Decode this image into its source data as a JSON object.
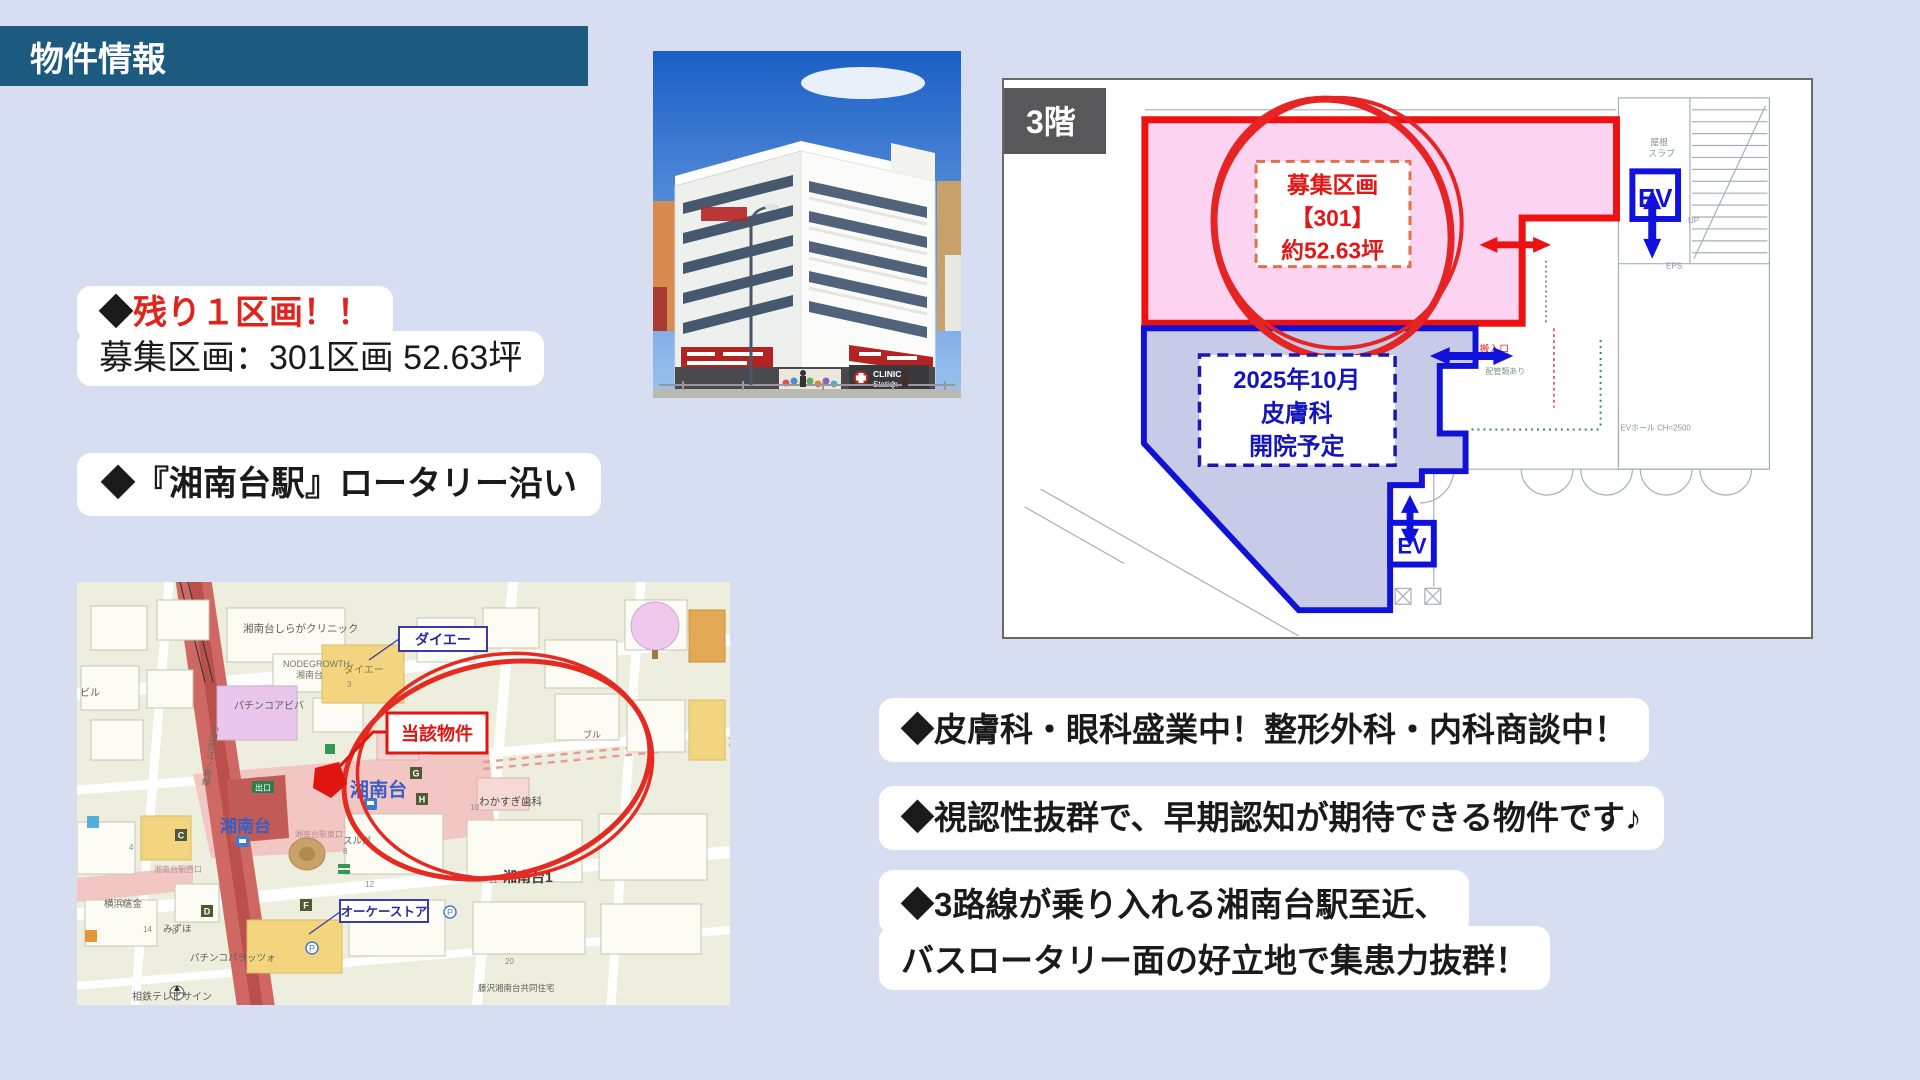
{
  "header": {
    "title": "物件情報"
  },
  "highlights": {
    "diamond": "◆",
    "remaining": "残り１区画！！",
    "section": "募集区画：301区画 52.63坪",
    "station": "◆『湘南台駅』ロータリー沿い"
  },
  "photo": {
    "sign_clinic_1": "CLINIC",
    "sign_clinic_2": "Station",
    "sign_entrance": "← 入口"
  },
  "floorplan": {
    "floor_badge": "3階",
    "recruit_1": "募集区画",
    "recruit_2": "【301】",
    "recruit_3": "約52.63坪",
    "tenant_1": "2025年10月",
    "tenant_2": "皮膚科",
    "tenant_3": "開院予定",
    "ev": "EV",
    "notes": {
      "roof_1": "屋根",
      "roof_2": "スラブ",
      "pipes": "配管類あり",
      "ev_hall": "EVホール CH=2500",
      "up": "UP",
      "eps": "EPS",
      "entrance": "搬入口"
    }
  },
  "map": {
    "callout_subject": "当該物件",
    "callout_daiei": "ダイエー",
    "callout_ok": "オーケーストア",
    "station_1": "湘南台",
    "station_2": "湘南台",
    "labels": {
      "shiraga": "湘南台しらがクリニック",
      "nodegrowth": "NODEGROWTH",
      "nodegrowth2": "湘南台",
      "daiei_bldg": "ダイエー",
      "aviva": "パチンコアビバ",
      "biru": "ビル",
      "wakasugi": "わかすぎ歯科",
      "suruga": "スルガ",
      "east_exit": "湘南台駅東口",
      "west_exit": "湘南台駅西口",
      "yokohama_shinkin": "横浜信金",
      "mizuho": "みずほ",
      "palazzo": "パチンコパラッツォ",
      "shonandai1": "湘南台1",
      "kyodo_jutaku": "藤沢湘南台共同住宅",
      "sotetsu_sign": "相鉄テレビサイン",
      "odakyu_line": "小田急江ノ島線",
      "buru": "ブル",
      "exit": "出口"
    },
    "numbers": [
      "3",
      "8",
      "12",
      "13",
      "14",
      "11",
      "20",
      "10",
      "4",
      "8"
    ],
    "letters": [
      "C",
      "D",
      "F",
      "G",
      "H"
    ],
    "p_icon": "P"
  },
  "benefits": {
    "b1": "◆皮膚科・眼科盛業中！整形外科・内科商談中！",
    "b2": "◆視認性抜群で、早期認知が期待できる物件です♪",
    "b3_1": "◆3路線が乗り入れる湘南台駅至近、",
    "b3_2": "バスロータリー面の好立地で集患力抜群！"
  },
  "colors": {
    "banner_blue": "#1d5a80",
    "accent_red": "#e0241d",
    "plan_red": "#ee1111",
    "plan_blue": "#1212d6",
    "pink_fill": "#fcd3f1",
    "blue_fill": "#c7cbe8"
  }
}
